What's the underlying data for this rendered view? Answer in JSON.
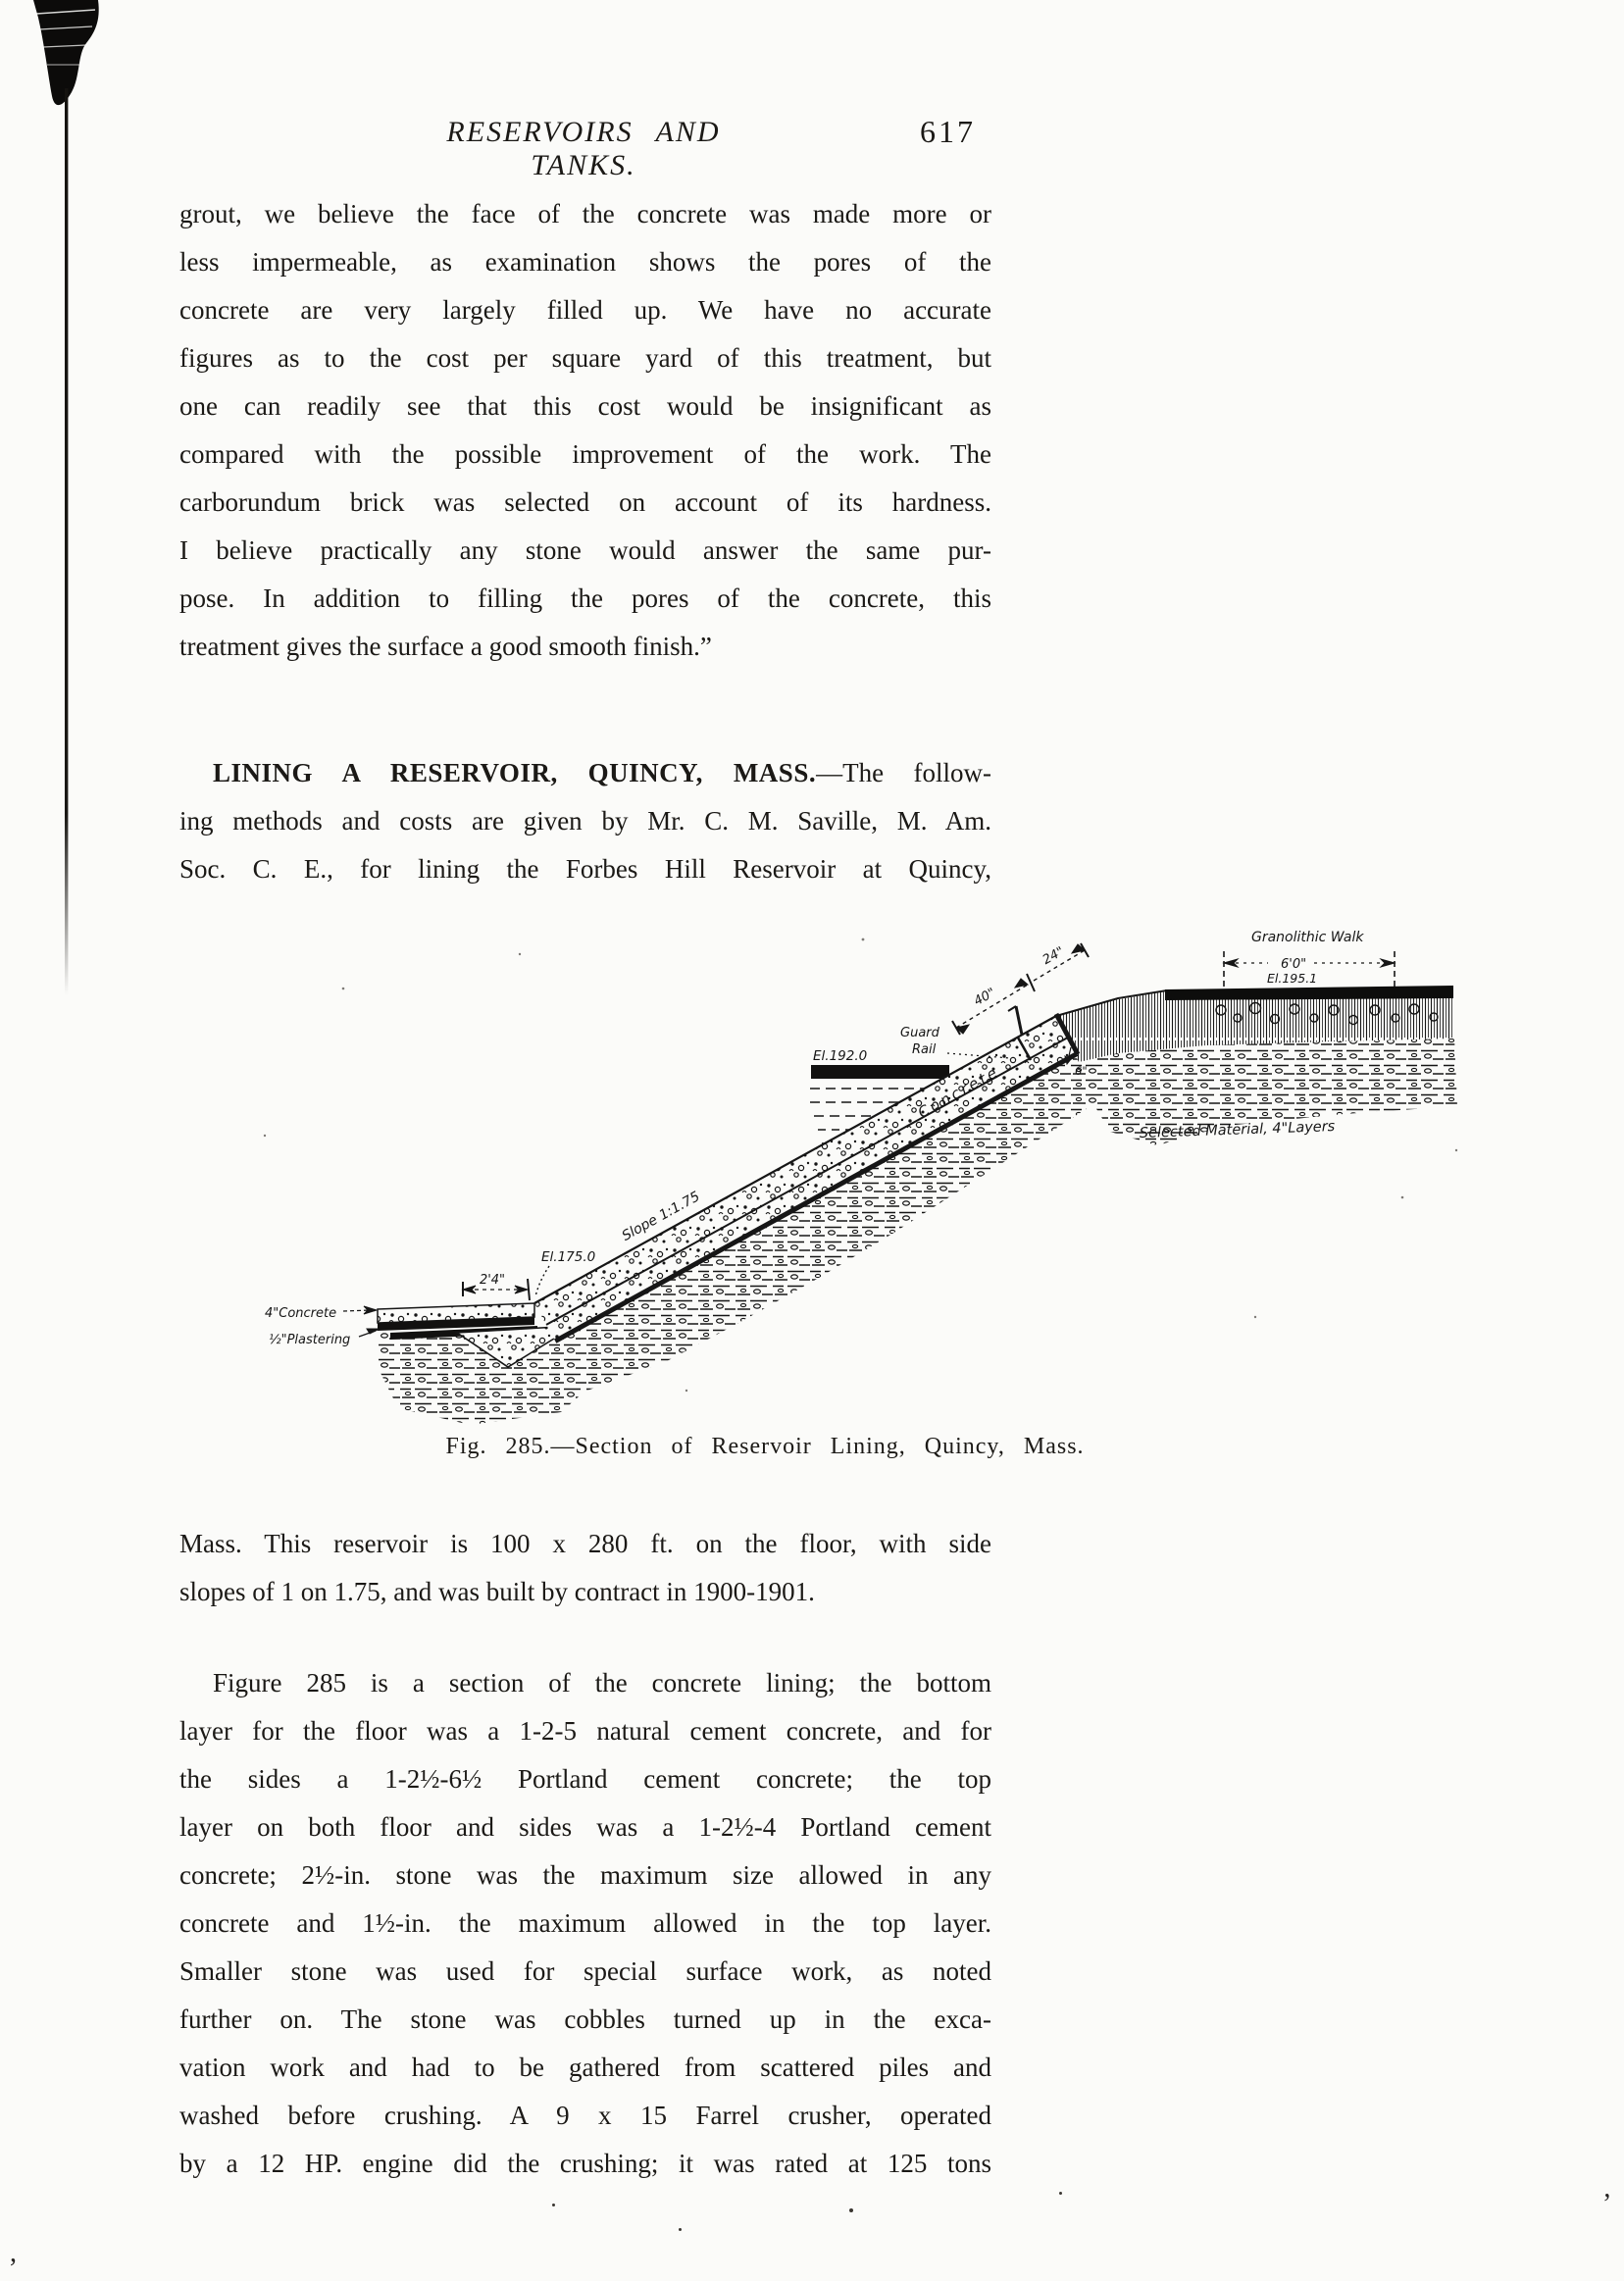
{
  "header": {
    "title": "RESERVOIRS AND TANKS.",
    "page_number": "617"
  },
  "paragraphs": {
    "p1": {
      "lines": [
        "grout, we believe the face of the concrete was made more or",
        "less impermeable, as examination shows the pores of the",
        "concrete are very largely filled up.  We have no accurate",
        "figures as to the cost per square yard of this treatment, but",
        "one can readily see that this cost would be insignificant as",
        "compared with the possible improvement of the work.  The",
        "carborundum brick was selected on account of its hardness.",
        "I believe practically any stone would answer the same pur-",
        "pose.  In addition to filling the pores of the concrete, this",
        "treatment gives the surface a good smooth finish.”"
      ]
    },
    "p2": {
      "heading_bold": "LINING A RESERVOIR, QUINCY, MASS.",
      "heading_rest": "—The follow-",
      "lines": [
        "ing methods and costs are given by Mr. C. M. Saville, M. Am.",
        "Soc. C. E., for lining the Forbes Hill Reservoir at Quincy,"
      ]
    },
    "p3": {
      "lines": [
        "Mass.  This reservoir is 100 x 280 ft. on the floor, with side",
        "slopes of 1 on 1.75, and was built by contract in 1900-1901."
      ]
    },
    "p4": {
      "lines": [
        "Figure 285 is a section of the concrete lining; the bottom",
        "layer for the floor was a 1-2-5 natural cement concrete, and for",
        "the sides a 1-2½-6½ Portland cement concrete; the top",
        "layer on both floor and sides was a 1-2½-4 Portland cement",
        "concrete; 2½-in. stone was the maximum size allowed in any",
        "concrete and 1½-in. the maximum allowed in the top layer.",
        "Smaller stone was used for special surface work, as noted",
        "further on.  The stone was cobbles turned up in the exca-",
        "vation work and had to be gathered from scattered piles and",
        "washed before crushing.  A 9 x 15 Farrel crusher, operated",
        "by a 12 HP. engine did the crushing; it was rated at 125 tons"
      ]
    }
  },
  "figure": {
    "caption": "Fig. 285.—Section of Reservoir Lining, Quincy, Mass.",
    "labels": {
      "granolithic_walk": "Granolithic Walk",
      "walk_width": "6'0\"",
      "el_195": "El.195.1",
      "el_192": "El.192.0",
      "el_175": "El.175.0",
      "guard_1": "Guard",
      "guard_2": "Rail",
      "dim_40": "40\"",
      "dim_24": "24\"",
      "dim_6": "6\"",
      "slope": "Slope 1:1.75",
      "concrete": "Concrete",
      "floor_dim": "2'4\"",
      "floor_concrete": "4\"Concrete",
      "floor_plastering": "½\"Plastering",
      "selected_material": "Selected Material, 4\"Layers"
    }
  },
  "artifacts": {
    "comma": ",",
    "apostrophe": "’"
  }
}
